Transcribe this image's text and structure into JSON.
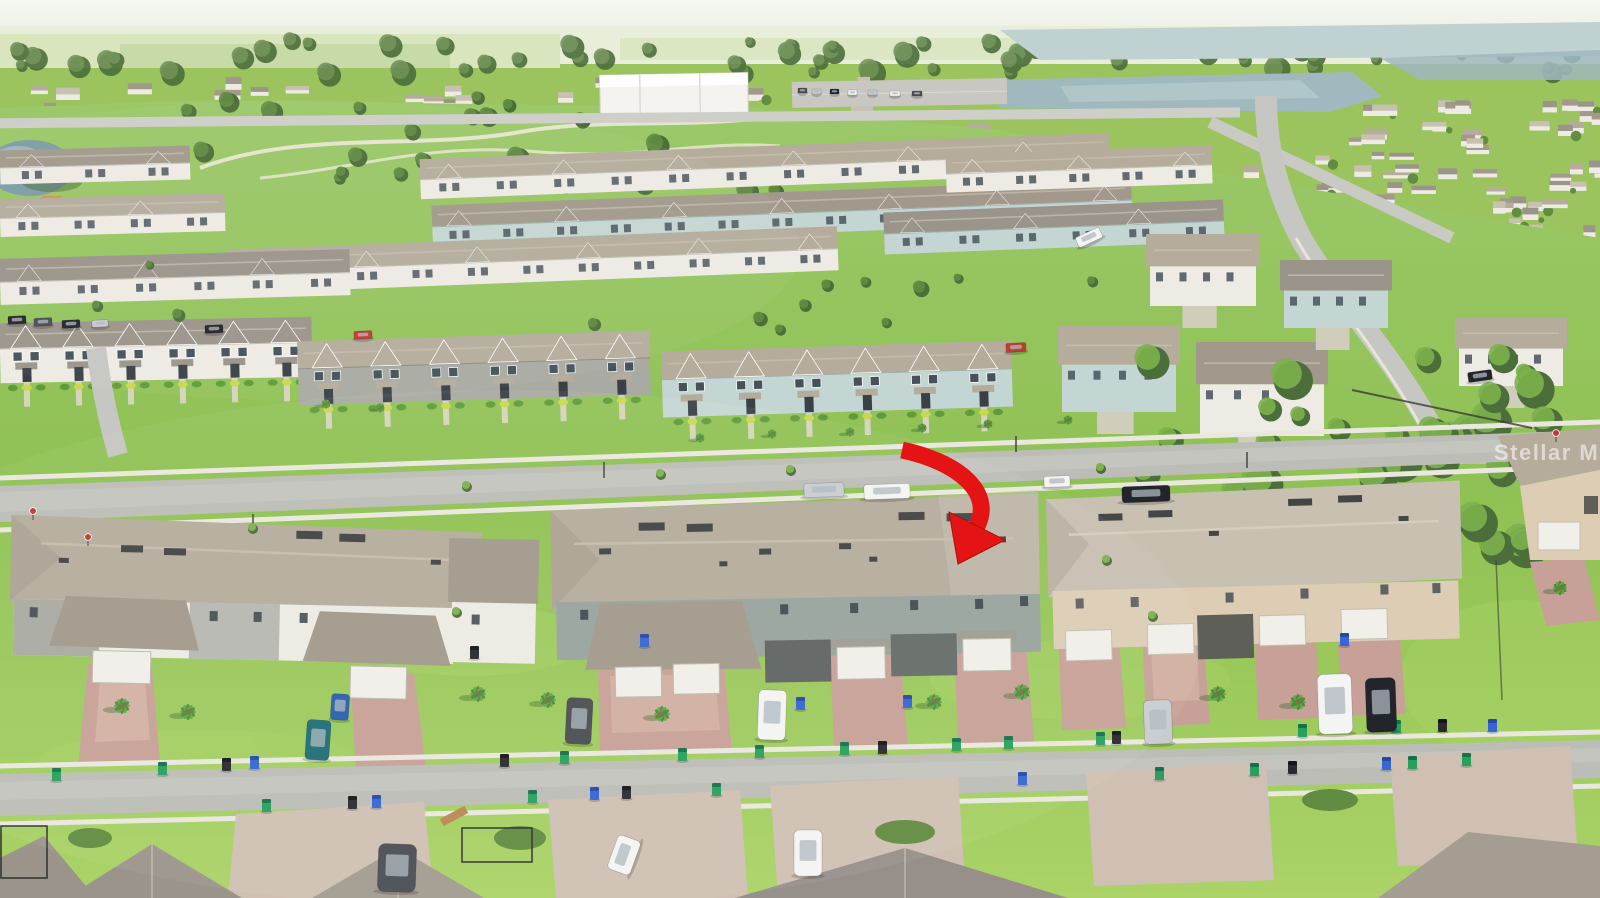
{
  "photo": {
    "kind": "aerial drone photograph",
    "subject": "suburban townhome community with red arrow marking the subject property",
    "width_px": 1600,
    "height_px": 898
  },
  "watermark": {
    "text": "Stellar MLS"
  },
  "arrow": {
    "color": "#e41414",
    "tail_x": 902,
    "tail_y": 450,
    "tip_x": 958,
    "tip_y": 564
  },
  "palette": {
    "sky_top": "#f5f7f1",
    "sky_bottom": "#e9efe2",
    "field_light": "#d8e5bd",
    "field_mid": "#c2d8a3",
    "field_pale": "#e7eeda",
    "treeline": "#6a8c53",
    "tree_dark": "#4c6e3b",
    "tree_mid": "#618c41",
    "tree_bright": "#7cb14c",
    "water": "#9fb9be",
    "water_light": "#c0d1d1",
    "pond": "#7d9da6",
    "grass": "#8fc153",
    "grass_light": "#abd367",
    "grass_dark": "#6fa53f",
    "street": "#bcbdb7",
    "street_light": "#cbccc6",
    "sidewalk": "#eae8de",
    "roof_tan": "#b5ac9c",
    "roof_dark": "#a2998c",
    "roof_light": "#c8c0b1",
    "roof_gray": "#9b948a",
    "wall_white": "#edebe3",
    "wall_sage": "#99a49d",
    "wall_blue": "#c4d6d3",
    "wall_cream": "#ddcdb5",
    "wall_gray": "#a9aba3",
    "garage_door": "#f1efe9",
    "driveway_brick": "#c7a197",
    "driveway_light": "#d9bdae",
    "paver": "#cfc0b3",
    "bin_green": "#27a05c",
    "bin_blue": "#3566d4",
    "bin_black": "#2a2b2e",
    "car_white": "#f4f4f2",
    "car_silver": "#c9cdd0",
    "car_black": "#22262a",
    "car_teal": "#1e6e78",
    "car_red": "#c23b31",
    "car_darkgray": "#4a4f54",
    "car_blue": "#2a5fae",
    "arrow_red": "#e41414",
    "watermark_fill": "rgba(255,255,255,0.55)",
    "path_sand": "#ece8d6"
  },
  "scene": {
    "distant_bands": [
      {
        "x": 0,
        "y": 76,
        "w": 1020,
        "h": 88,
        "count": 95,
        "seed": 7
      },
      {
        "x": 1000,
        "y": 150,
        "w": 600,
        "h": 85,
        "count": 60,
        "seed": 11
      },
      {
        "x": 1340,
        "y": 96,
        "w": 260,
        "h": 52,
        "count": 22,
        "seed": 5
      },
      {
        "x": 60,
        "y": 168,
        "w": 360,
        "h": 40,
        "count": 18,
        "seed": 9
      }
    ],
    "tree_line": {
      "region": [
        0,
        40,
        1600,
        34
      ],
      "count": 60,
      "seed": 3,
      "rmin": 5,
      "rmax": 13,
      "dark": "tree_dark",
      "light": "treeline"
    },
    "park_trees": {
      "region": [
        140,
        96,
        640,
        96
      ],
      "count": 24,
      "seed": 13,
      "rmin": 5,
      "rmax": 12,
      "dark": "tree_dark",
      "light": "tree_mid"
    },
    "forest": {
      "region": [
        1140,
        352,
        420,
        210
      ],
      "count": 46,
      "seed": 21,
      "rmin": 9,
      "rmax": 21,
      "dark": "tree_dark",
      "light": "tree_bright"
    },
    "mid_trees": {
      "region": [
        0,
        262,
        1120,
        70
      ],
      "count": 14,
      "seed": 31,
      "rmin": 4,
      "rmax": 8,
      "dark": "tree_dark",
      "light": "tree_mid"
    },
    "street_trees": [
      [
        660,
        474
      ],
      [
        1100,
        468
      ],
      [
        252,
        528
      ],
      [
        456,
        612
      ],
      [
        1152,
        616
      ],
      [
        790,
        470
      ],
      [
        466,
        486
      ],
      [
        1106,
        560
      ]
    ],
    "rows": [
      {
        "x": 420,
        "y": 146,
        "w": 690,
        "h": 40,
        "a": -2.2,
        "roof": "roof_tan",
        "wall": "wall_white",
        "style": "back"
      },
      {
        "x": 432,
        "y": 192,
        "w": 700,
        "h": 42,
        "a": -2.2,
        "roof": "roof_dark",
        "wall": "wall_blue",
        "style": "back"
      },
      {
        "x": 228,
        "y": 238,
        "w": 610,
        "h": 44,
        "a": -2.2,
        "roof": "roof_tan",
        "wall": "wall_white",
        "style": "back"
      },
      {
        "x": 884,
        "y": 206,
        "w": 340,
        "h": 42,
        "a": -2.2,
        "roof": "roof_gray",
        "wall": "wall_blue",
        "style": "back"
      },
      {
        "x": 0,
        "y": 254,
        "w": 350,
        "h": 46,
        "a": -1.6,
        "roof": "roof_gray",
        "wall": "wall_white",
        "style": "back"
      },
      {
        "x": 946,
        "y": 150,
        "w": 266,
        "h": 38,
        "a": -2,
        "roof": "roof_tan",
        "wall": "wall_white",
        "style": "back"
      },
      {
        "x": 0,
        "y": 148,
        "w": 190,
        "h": 34,
        "a": -1.5,
        "roof": "roof_dark",
        "wall": "wall_white",
        "style": "back"
      },
      {
        "x": 0,
        "y": 196,
        "w": 225,
        "h": 38,
        "a": -1.5,
        "roof": "roof_tan",
        "wall": "wall_white",
        "style": "back"
      },
      {
        "x": 0,
        "y": 320,
        "w": 312,
        "h": 60,
        "a": -1.2,
        "roof": "roof_gray",
        "wall": "wall_white",
        "style": "front"
      },
      {
        "x": 298,
        "y": 336,
        "w": 352,
        "h": 64,
        "a": -1.8,
        "roof": "roof_tan",
        "wall": "wall_gray",
        "style": "front"
      },
      {
        "x": 662,
        "y": 346,
        "w": 350,
        "h": 66,
        "a": -1.8,
        "roof": "roof_tan",
        "wall": "wall_blue",
        "style": "front"
      }
    ],
    "houses": [
      {
        "x": 1058,
        "y": 326,
        "w": 122,
        "h": 86,
        "roof": "roof_tan",
        "wall": "wall_blue"
      },
      {
        "x": 1196,
        "y": 342,
        "w": 132,
        "h": 94,
        "roof": "roof_dark",
        "wall": "wall_white"
      },
      {
        "x": 1146,
        "y": 234,
        "w": 114,
        "h": 72,
        "roof": "roof_tan",
        "wall": "wall_white"
      },
      {
        "x": 1280,
        "y": 260,
        "w": 112,
        "h": 68,
        "roof": "roof_gray",
        "wall": "wall_blue"
      },
      {
        "x": 1455,
        "y": 318,
        "w": 112,
        "h": 68,
        "roof": "roof_tan",
        "wall": "wall_white"
      }
    ],
    "bins": [
      [
        52,
        768,
        "g"
      ],
      [
        158,
        762,
        "g"
      ],
      [
        222,
        758,
        "k"
      ],
      [
        250,
        756,
        "b"
      ],
      [
        500,
        754,
        "k"
      ],
      [
        560,
        751,
        "g"
      ],
      [
        678,
        748,
        "g"
      ],
      [
        755,
        745,
        "g"
      ],
      [
        840,
        742,
        "g"
      ],
      [
        878,
        741,
        "k"
      ],
      [
        952,
        738,
        "g"
      ],
      [
        1004,
        736,
        "g"
      ],
      [
        1096,
        732,
        "g"
      ],
      [
        1112,
        731,
        "k"
      ],
      [
        1298,
        724,
        "g"
      ],
      [
        1392,
        720,
        "g"
      ],
      [
        1438,
        719,
        "k"
      ],
      [
        1488,
        719,
        "b"
      ],
      [
        262,
        799,
        "g"
      ],
      [
        348,
        796,
        "k"
      ],
      [
        372,
        795,
        "b"
      ],
      [
        528,
        790,
        "g"
      ],
      [
        590,
        787,
        "b"
      ],
      [
        622,
        786,
        "k"
      ],
      [
        712,
        783,
        "g"
      ],
      [
        1018,
        772,
        "b"
      ],
      [
        1155,
        767,
        "g"
      ],
      [
        1250,
        763,
        "g"
      ],
      [
        1288,
        761,
        "k"
      ],
      [
        1382,
        757,
        "b"
      ],
      [
        1408,
        756,
        "g"
      ],
      [
        1462,
        753,
        "g"
      ],
      [
        796,
        697,
        "b"
      ],
      [
        903,
        695,
        "b"
      ],
      [
        1340,
        633,
        "b"
      ],
      [
        640,
        634,
        "b"
      ],
      [
        470,
        646,
        "k"
      ]
    ],
    "cars": [
      [
        804,
        483,
        40,
        14,
        -2,
        "car_silver"
      ],
      [
        864,
        484,
        46,
        15,
        -2,
        "car_white"
      ],
      [
        1122,
        486,
        48,
        16,
        -2,
        "car_black"
      ],
      [
        1044,
        476,
        26,
        11,
        -2,
        "car_white"
      ],
      [
        1076,
        232,
        26,
        11,
        -25,
        "car_white"
      ],
      [
        1006,
        343,
        20,
        9,
        -3,
        "car_red"
      ],
      [
        1468,
        371,
        24,
        10,
        -8,
        "car_black"
      ],
      [
        8,
        316,
        18,
        8,
        -3,
        "car_black"
      ],
      [
        34,
        318,
        18,
        8,
        -3,
        "car_darkgray"
      ],
      [
        62,
        320,
        18,
        8,
        -3,
        "car_black"
      ],
      [
        92,
        320,
        16,
        7,
        -3,
        "car_silver"
      ],
      [
        205,
        325,
        18,
        8,
        -3,
        "car_black"
      ],
      [
        354,
        331,
        18,
        8,
        -3,
        "car_red"
      ],
      [
        798,
        88,
        9,
        5,
        0,
        "car_darkgray"
      ],
      [
        812,
        89,
        9,
        5,
        0,
        "car_silver"
      ],
      [
        830,
        89,
        9,
        5,
        0,
        "car_black"
      ],
      [
        848,
        90,
        9,
        5,
        0,
        "car_white"
      ],
      [
        868,
        90,
        9,
        5,
        0,
        "car_silver"
      ],
      [
        890,
        91,
        10,
        5,
        0,
        "car_white"
      ],
      [
        912,
        91,
        10,
        5,
        0,
        "car_darkgray"
      ],
      [
        306,
        720,
        24,
        40,
        4,
        "car_teal"
      ],
      [
        331,
        694,
        18,
        26,
        4,
        "car_blue"
      ],
      [
        566,
        698,
        26,
        46,
        3,
        "car_darkgray"
      ],
      [
        758,
        690,
        28,
        50,
        2,
        "car_white"
      ],
      [
        1144,
        700,
        28,
        44,
        -2,
        "car_silver"
      ],
      [
        1318,
        674,
        34,
        60,
        -2,
        "car_white"
      ],
      [
        1366,
        678,
        30,
        54,
        -2,
        "car_black"
      ],
      [
        378,
        844,
        38,
        48,
        2,
        "car_darkgray"
      ],
      [
        606,
        843,
        36,
        24,
        -70,
        "car_white"
      ],
      [
        794,
        830,
        28,
        46,
        0,
        "car_white"
      ]
    ],
    "palms": [
      [
        122,
        706,
        1
      ],
      [
        188,
        712,
        1
      ],
      [
        478,
        694,
        1
      ],
      [
        548,
        700,
        1
      ],
      [
        662,
        714,
        1
      ],
      [
        934,
        702,
        1
      ],
      [
        1022,
        692,
        1
      ],
      [
        1218,
        694,
        1
      ],
      [
        1298,
        702,
        1
      ],
      [
        1560,
        588,
        0.9
      ],
      [
        700,
        438,
        0.6
      ],
      [
        772,
        434,
        0.6
      ],
      [
        850,
        432,
        0.6
      ],
      [
        922,
        428,
        0.6
      ],
      [
        988,
        424,
        0.6
      ],
      [
        380,
        408,
        0.6
      ],
      [
        326,
        404,
        0.6
      ],
      [
        1068,
        420,
        0.6
      ]
    ],
    "signs": [
      [
        33,
        511
      ],
      [
        88,
        537
      ],
      [
        1556,
        433
      ]
    ]
  }
}
